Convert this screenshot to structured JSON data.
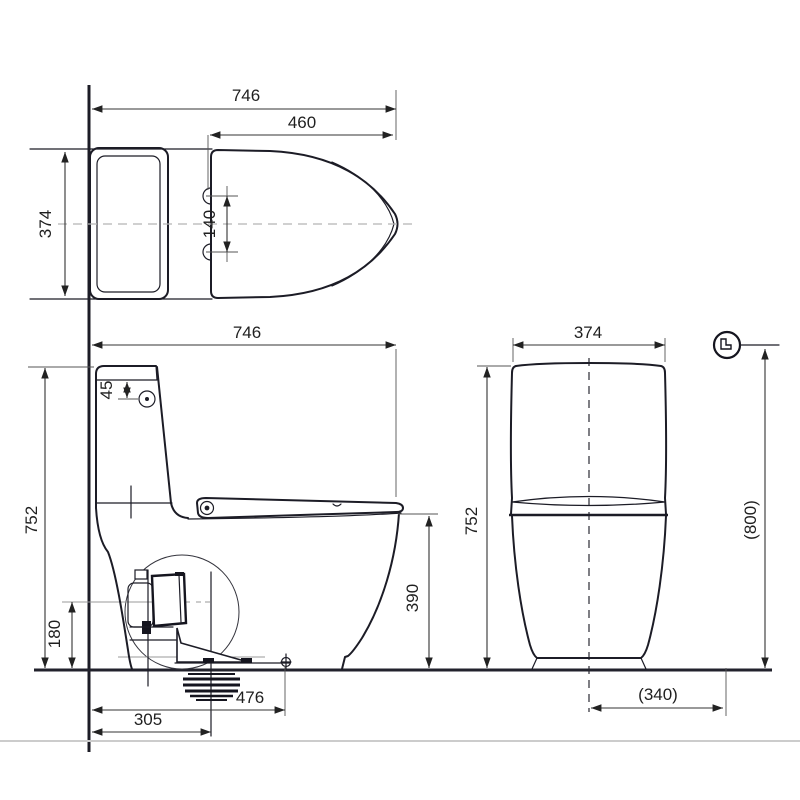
{
  "drawing": {
    "type": "technical-dimension-diagram",
    "subject": "two-piece toilet with seat, three orthographic views",
    "colors": {
      "line": "#1c1c26",
      "dim_text": "#1f1f1f",
      "aux_line": "#999999",
      "faint_line": "#cccccc",
      "background": "#ffffff"
    },
    "icons": {
      "seat_open_indicator": "toilet-side-icon-in-circle"
    },
    "dims": {
      "top_overall_depth": "746",
      "top_seat_length": "460",
      "top_width": "374",
      "top_hinge_hole_spacing": "140",
      "side_overall_depth": "746",
      "side_button_offset": "45",
      "side_overall_height": "752",
      "side_outlet_height": "180",
      "side_rim_height": "390",
      "side_bolt_distance": "476",
      "side_rough_in": "305",
      "front_width": "374",
      "front_height": "752",
      "front_height_seat_open": "(800)",
      "front_center_offset": "(340)"
    }
  }
}
